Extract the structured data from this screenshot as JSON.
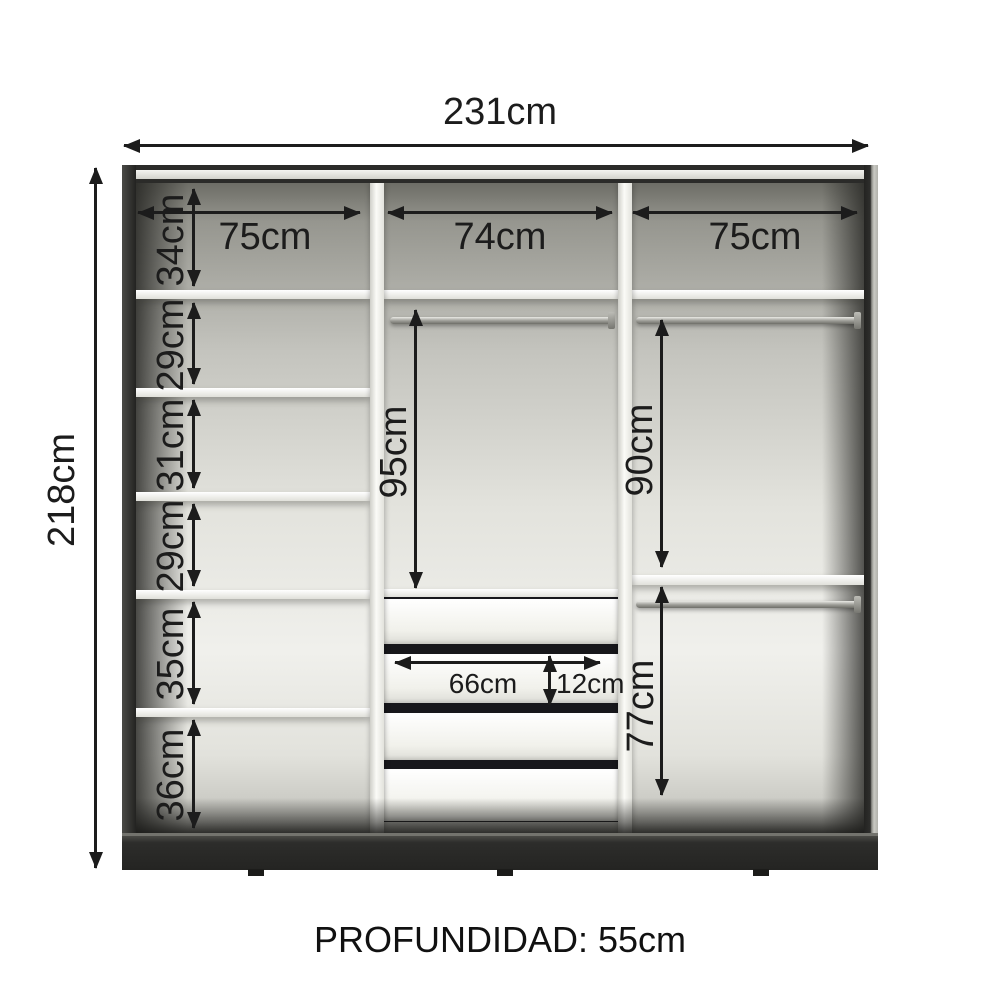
{
  "labels": {
    "total_width": "231cm",
    "total_height": "218cm",
    "depth": "PROFUNDIDAD: 55cm",
    "column_widths": [
      "75cm",
      "74cm",
      "75cm"
    ],
    "left_sections": [
      "34cm",
      "29cm",
      "31cm",
      "29cm",
      "35cm",
      "36cm"
    ],
    "middle_hanging_height": "95cm",
    "right_upper_hanging_height": "90cm",
    "right_lower_hanging_height": "77cm",
    "drawer_width": "66cm",
    "drawer_height": "12cm"
  },
  "structure": {
    "columns": 3,
    "left_shelf_count": 5,
    "drawer_count": 4,
    "hanging_rod_count": 3
  },
  "colors": {
    "frame_dark": "#2b2b29",
    "shelf_white": "#f8f8f4",
    "interior_gray": "#d8d8d2",
    "dimension_ink": "#1c1c1c",
    "background": "#ffffff"
  }
}
